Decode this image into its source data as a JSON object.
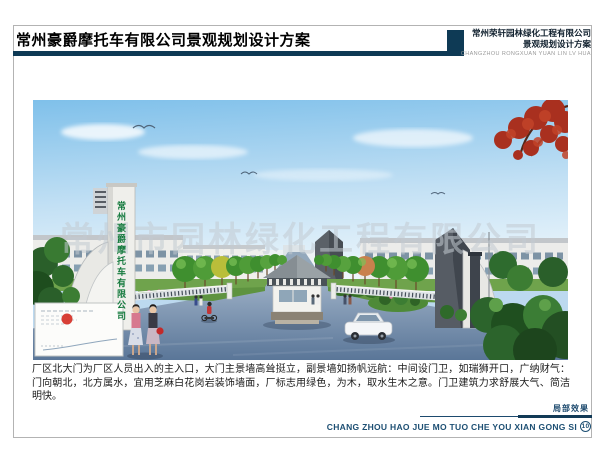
{
  "header": {
    "title": "常州豪爵摩托车有限公司景观规划设计方案",
    "company": {
      "name": "常州荣轩园林绿化工程有限公司",
      "subtitle": "景观规划设计方案",
      "pinyin": "CHANGZHOU RONGXUAN YUAN LIN LV HUA"
    }
  },
  "artwork": {
    "gate_sign": "常州豪爵摩托车有限公司",
    "watermark": "常州市园林绿化工程有限公司"
  },
  "description": {
    "text": "厂区北大门为厂区人员出入的主入口，大门主景墙高耸挺立，副景墙如扬帆远航：中间设门卫，如瑞狮开口，广纳财气：门向朝北，北方属水，宜用芝麻白花岗岩装饰墙面，厂标志用绿色，为木，取水生木之意。门卫建筑力求舒展大气、简洁明快。"
  },
  "footer": {
    "caption": "局部效果",
    "pinyin": "CHANG ZHOU HAO JUE MO TUO CHE YOU XIAN GONG SI",
    "page_number": "10"
  },
  "colors": {
    "navy": "#0e3a55",
    "footer_navy": "#1d4f73",
    "sign_green": "#157a3e",
    "stamp_red": "#d42a20"
  }
}
